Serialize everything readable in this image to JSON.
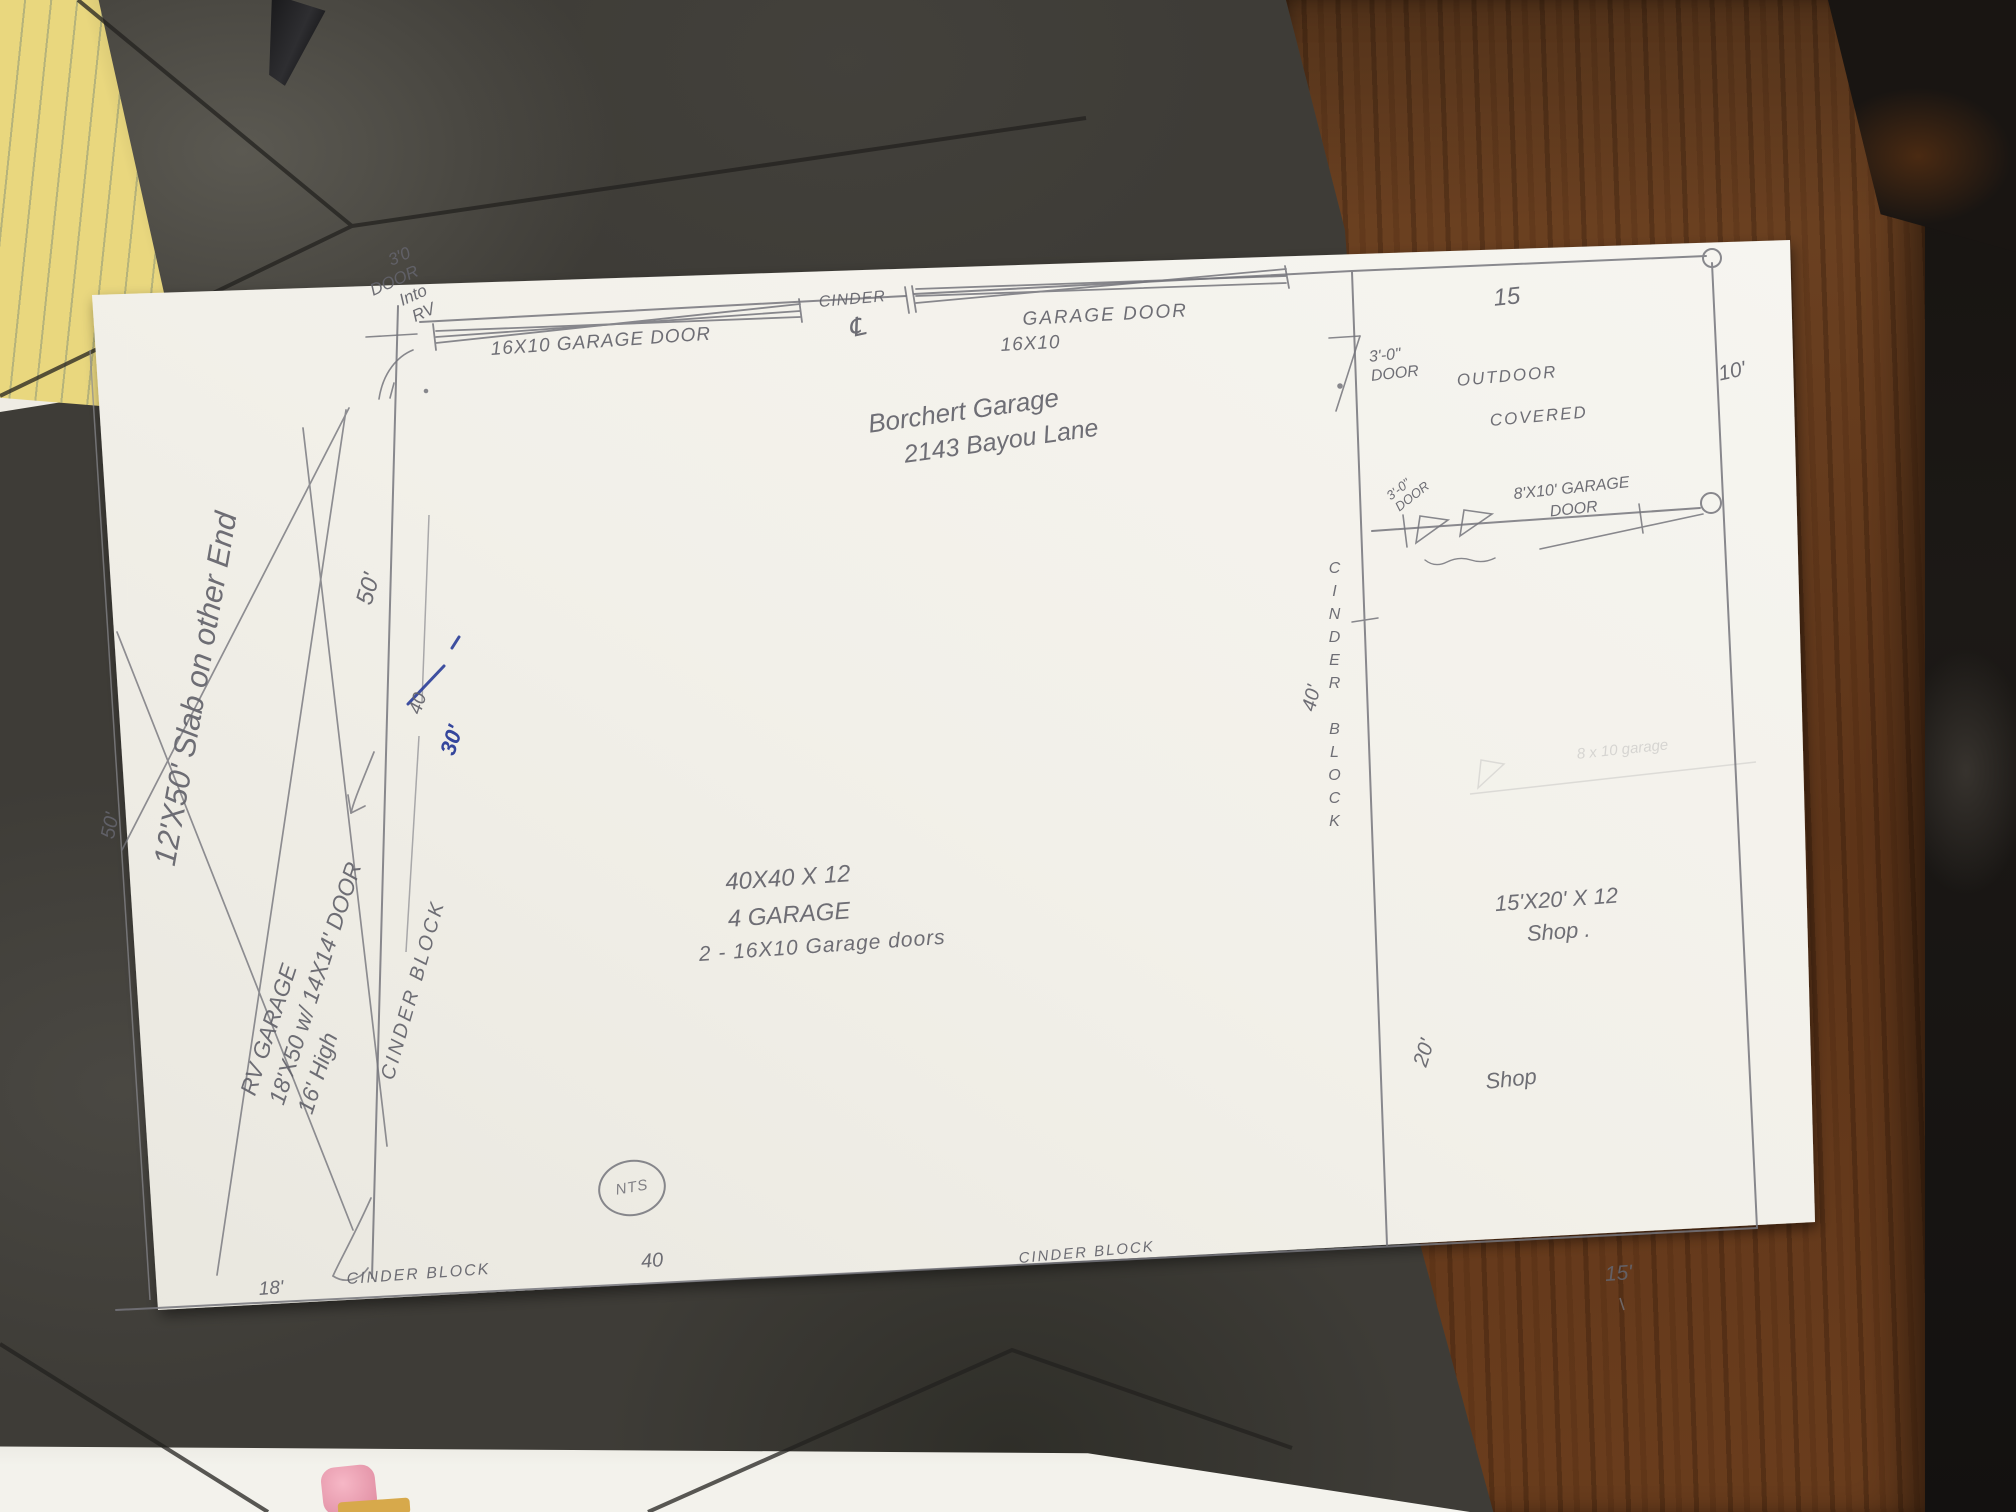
{
  "sketch": {
    "labels": {
      "door_into_rv": "3'0\nDOOR\nInto\nRV",
      "garage_door_left": "16X10 GARAGE DOOR",
      "cinder": "CINDER",
      "centerline_symbol": "℄",
      "garage_door_right_l1": "GARAGE DOOR",
      "garage_door_right_l2": "16X10",
      "title_l1": "Borchert Garage",
      "title_l2": "2143 Bayou Lane",
      "door_3_0": "3'-0\"\nDOOR",
      "outdoor": "OUTDOOR",
      "covered": "COVERED",
      "dim_15_top": "15",
      "dim_10_right": "10'",
      "door_3_0_small": "3'-0\"\nDOOR",
      "garage_door_8x10": "8'X10' GARAGE\nDOOR",
      "cinder_block_right": "CINDER BLOCK",
      "dim_40_right": "40'",
      "slab_note": "12'X50' Slab on other End",
      "dim_50_left": "50'",
      "rv_garage": "RV GARAGE\n18'X50 w/ 14X14' DOOR\n16' High",
      "cinder_block_left": "CINDER BLOCK",
      "dim_50_mid": "50'",
      "dim_40_crossed": "40",
      "dim_30_blue": "30'",
      "spec_main": "40X40 X 12\n4 GARAGE",
      "spec_doors": "2 - 16X10 Garage doors",
      "spec_shop": "15'X20' X 12\nShop .",
      "shop": "Shop",
      "dim_20": "20'",
      "nts": "NTS",
      "dim_40_bottom": "40",
      "cinder_block_bottom_mid": "CINDER BLOCK",
      "cinder_block_bottom_left": "CINDER BLOCK",
      "dim_18": "18'",
      "dim_15_bottom": "15'",
      "ghost_note": "8 x 10 garage"
    },
    "colors": {
      "pencil": "#73737b",
      "ink_blue": "#2b3e99",
      "paper": "#f2f0e9",
      "wood": "#6a3f1f",
      "slate": "#3c3b37",
      "notepad": "#e9d77e"
    }
  }
}
